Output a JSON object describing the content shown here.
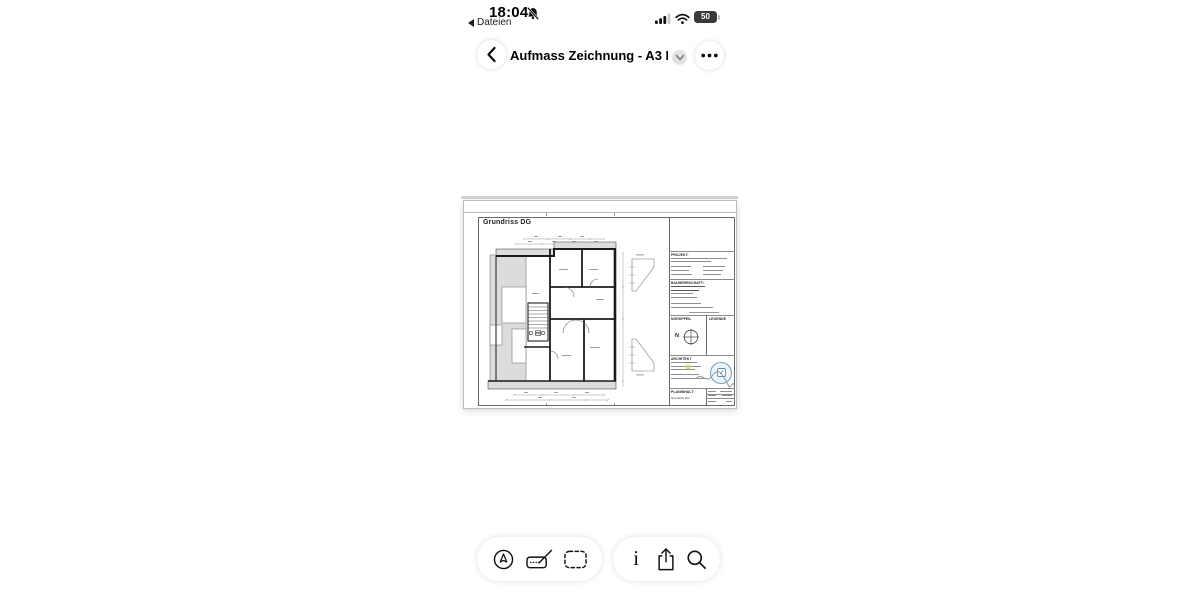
{
  "status_bar": {
    "time": "18:04",
    "back_to_app_label": "Dateien",
    "battery_percent": "50"
  },
  "nav": {
    "title": "Aufmass Zeichnung - A3 F..."
  },
  "sheet": {
    "drawing_title": "Grundriss DG",
    "title_block": {
      "projekt": "PROJEKT:",
      "bauherrschaft": "BAUHERRSCHAFT:",
      "nordpfeil": "NORDPFEIL",
      "legende": "LEGENDE",
      "north": "N",
      "architekt": "ARCHITEKT",
      "planinhalt": "PLANINHALT",
      "plan_name": "Grundriss DG"
    }
  },
  "toolbar": {
    "info_glyph": "i"
  },
  "colors": {
    "wall": "#1b1b1b",
    "roof_shade": "#dcdcdc",
    "stamp_blue": "#79a3c4",
    "highlight_yellow": "#e6d353",
    "sheet_border": "#bdbdbd"
  }
}
